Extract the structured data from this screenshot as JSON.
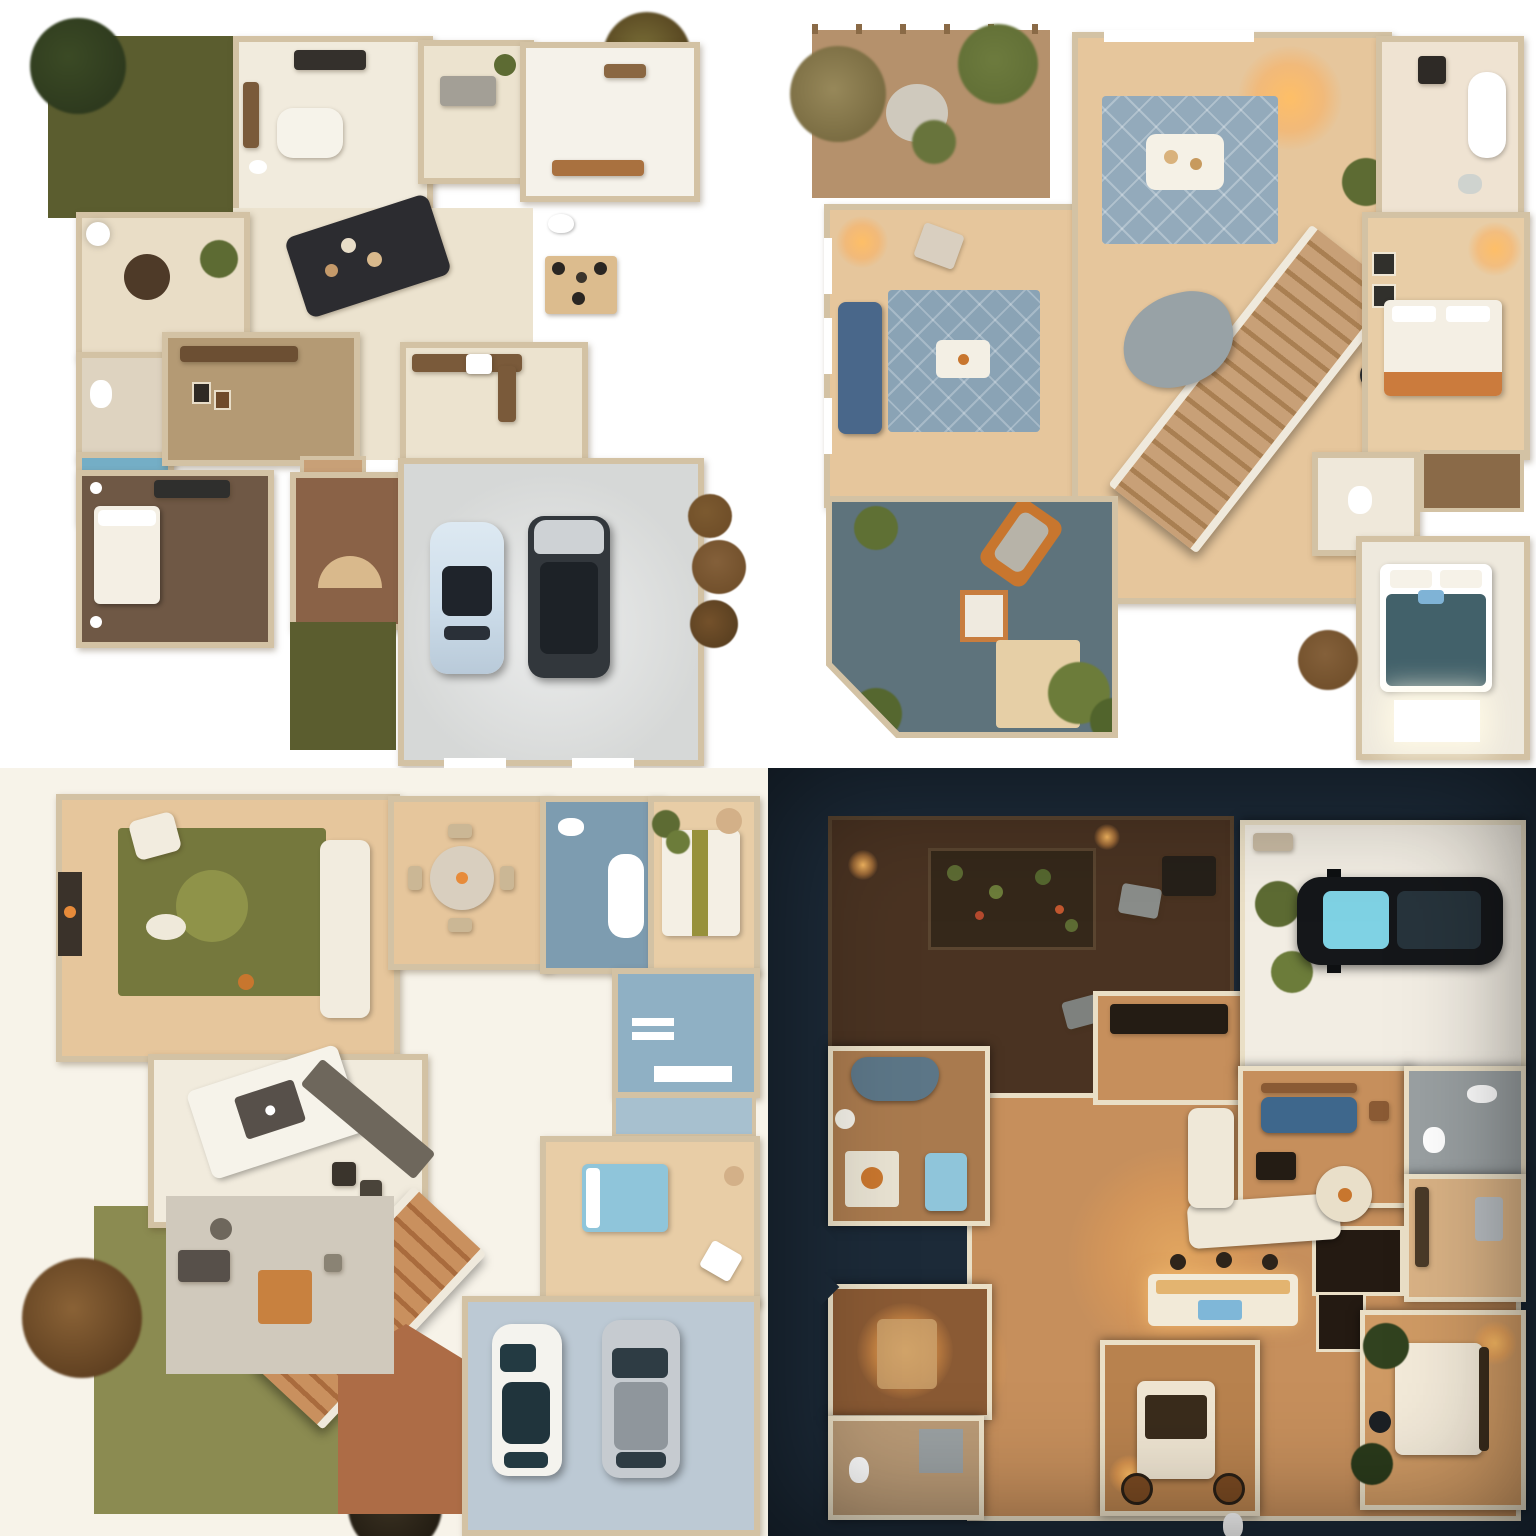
{
  "meta": {
    "kind": "ai-rendered floor plan concept grid",
    "rows": 2,
    "cols": 2,
    "canvas": "1536x1536",
    "text_content": "none — image contains no readable text, numbers or UI chrome"
  },
  "panels": [
    {
      "id": "panel-1",
      "position": "top-left",
      "scene": "Daytime top-down house plan: olive front lawn with bush, corner tree, kitchen with island, dark living sofa set, breakfast nook, two baths (one blue shower), brown-floor bedroom, entry with rear lawn strip, gray two-car garage holding a pale-blue sedan and a dark SUV, brown shrubs at right",
      "background_key": "page-bg",
      "objects": [
        "lawn",
        "bush",
        "tree",
        "kitchen-island",
        "stove",
        "living-sofa",
        "nook-rug",
        "ottoman",
        "toilet",
        "blue-shower",
        "bed",
        "dresser",
        "entry-fan",
        "garage",
        "car-pale-blue",
        "car-dark-suv",
        "shrubs"
      ]
    },
    {
      "id": "panel-2",
      "position": "top-right",
      "scene": "Top-down two-story plan: corner dirt garden with round paver and trellis, wood-floor living room with blue sofa and diamond blue rug, chandelier-lit hall with white coffee table, long diagonal staircase, curved gray lounge, slate-floor study with orange lounge chair and shrubs, right wing with bath, warm bedroom with orange-trim bed, closet shelves and teal-bed bedroom over a glowing skylight",
      "background_key": "page-bg",
      "objects": [
        "garden",
        "paver",
        "trellis",
        "blue-sofa",
        "diamond-rug",
        "coffee-table",
        "chandelier-glow",
        "staircase",
        "curved-lounge",
        "robot-vacuum",
        "study",
        "lounge-chair",
        "picture-frame",
        "floor-mat",
        "shrubs",
        "bathtub",
        "bed-orange-trim",
        "closet-shelves",
        "bed-teal",
        "skylight"
      ]
    },
    {
      "id": "panel-3",
      "position": "bottom-left",
      "scene": "Daytime plan on cream ground: lounge with green circle rug, white sectional and fireplace, round dining table, blue-tile bath with tub, striped-quilt bedroom, second blue bath, blue-bed room, white island kitchen with dark hood, diagonal orange staircase, terracotta entry, gray patio with desk, olive lawn, fluffy brown tree, dark bush, and blue-gray garage with white and silver cars",
      "background_key": "q3-bg",
      "objects": [
        "green-rug",
        "white-sectional",
        "fireplace",
        "dining-table",
        "bathtub",
        "striped-bed",
        "blue-bed",
        "kitchen-island",
        "range-hood",
        "staircase",
        "entry",
        "patio-desk",
        "orange-mat",
        "lawn",
        "tree",
        "bush",
        "garage",
        "car-white",
        "car-silver"
      ]
    },
    {
      "id": "panel-4",
      "position": "bottom-right",
      "scene": "Night scene on dark navy ground: plank deck with planter bed, gray ottomans and lanterns, lower deck with round orange table, warm-lit open living with white L-sofa, round dining table, island with blue tray, TV wall, single garage with black car with cyan glass, blue-sofa den, tiled bath, wine-rack nook, desk room, and three lamp-lit bedrooms with white and blue beds",
      "background_key": "q4-bg",
      "objects": [
        "deck",
        "planter-bed",
        "ottomans",
        "lanterns",
        "round-table",
        "l-sofa",
        "dining-table",
        "kitchen-island",
        "blue-tray",
        "tv-wall",
        "garage",
        "car-black",
        "blue-sofa",
        "tiled-bath",
        "wine-rack",
        "fridge",
        "bed-white",
        "bed-blue",
        "plants",
        "lamp-glows"
      ]
    }
  ],
  "palette": {
    "page-bg": "#ffffff",
    "q3-bg": "#f7f3e9",
    "q4-bg": "#1c2a38",
    "wall": "#d3c2a4",
    "wall-lit": "#eadfc6",
    "floor-cream": "#ece3cf",
    "floor-tile": "#f1ebdd",
    "floor-tan": "#e8cda6",
    "wood-light": "#e6c69c",
    "wood-mid": "#d9b285",
    "wood-warm": "#c68f5c",
    "wood-deep": "#8a5a34",
    "lawn-dark": "#5b5d2f",
    "lawn-light": "#8b8b51",
    "bush-dark": "#2e3a1e",
    "bush-green": "#5d6b33",
    "bush-brown": "#6b4a26",
    "dirt": "#b5916c",
    "paver": "#cfc9bd",
    "garage-gray": "#d6d8d7",
    "garage-blue": "#bcc9d4",
    "garage-white": "#f2ede3",
    "slate": "#5e737c",
    "rug-blue": "#8aa3b5",
    "rug-blue-2": "#93aabb",
    "rug-green": "#75783d",
    "rug-green-light": "#8f9349",
    "sofa-dark": "#2c2c30",
    "sofa-blue": "#49678a",
    "sofa-slate": "#5c7687",
    "sofa-white": "#f2ecdf",
    "bed-white": "#f4efe4",
    "bed-teal": "#42616a",
    "bed-blue": "#8fc5da",
    "bed-stripe": "#97913b",
    "stair-wood": "#c8a077",
    "stair-shadow": "#a97f52",
    "stair-orange": "#c9905e",
    "stair-orange-dark": "#a96b3d",
    "terracotta": "#ad6c46",
    "deck": "#4a3322",
    "deck-dark": "#35281a",
    "car-pale": "#cdddea",
    "car-dark": "#32373c",
    "suv-hood": "#ced2d5",
    "car-white": "#f4f3ee",
    "car-silver": "#c6cbd0",
    "silver-roof": "#8f969c",
    "car-black": "#15171a",
    "glass-dark": "#1f242b",
    "glass-teal": "#233a42",
    "glass-cyan": "#7fd2e4",
    "accent-orange": "#c8762e",
    "bath-blue": "#7d9cb0",
    "bath-blue-2": "#8fb0c4",
    "shower-blue": "#74aec6",
    "closet-blue": "#a7c0cf",
    "counter-brown": "#7a5a3a",
    "counter-dark": "#6e675c",
    "hood-dark": "#57504a",
    "patio-gray": "#d0c9bc",
    "mat-tan": "#e6cfa6",
    "wood-cab": "#8a6a48",
    "gray-object": "#98a2a6",
    "tile-gray": "#9aa0a2",
    "fridge": "#b9bec2",
    "rack-dark": "#241a12",
    "fire-dark": "#3a322a",
    "white-obj": "#f6f3ea",
    "dark-obj": "#241c14"
  }
}
